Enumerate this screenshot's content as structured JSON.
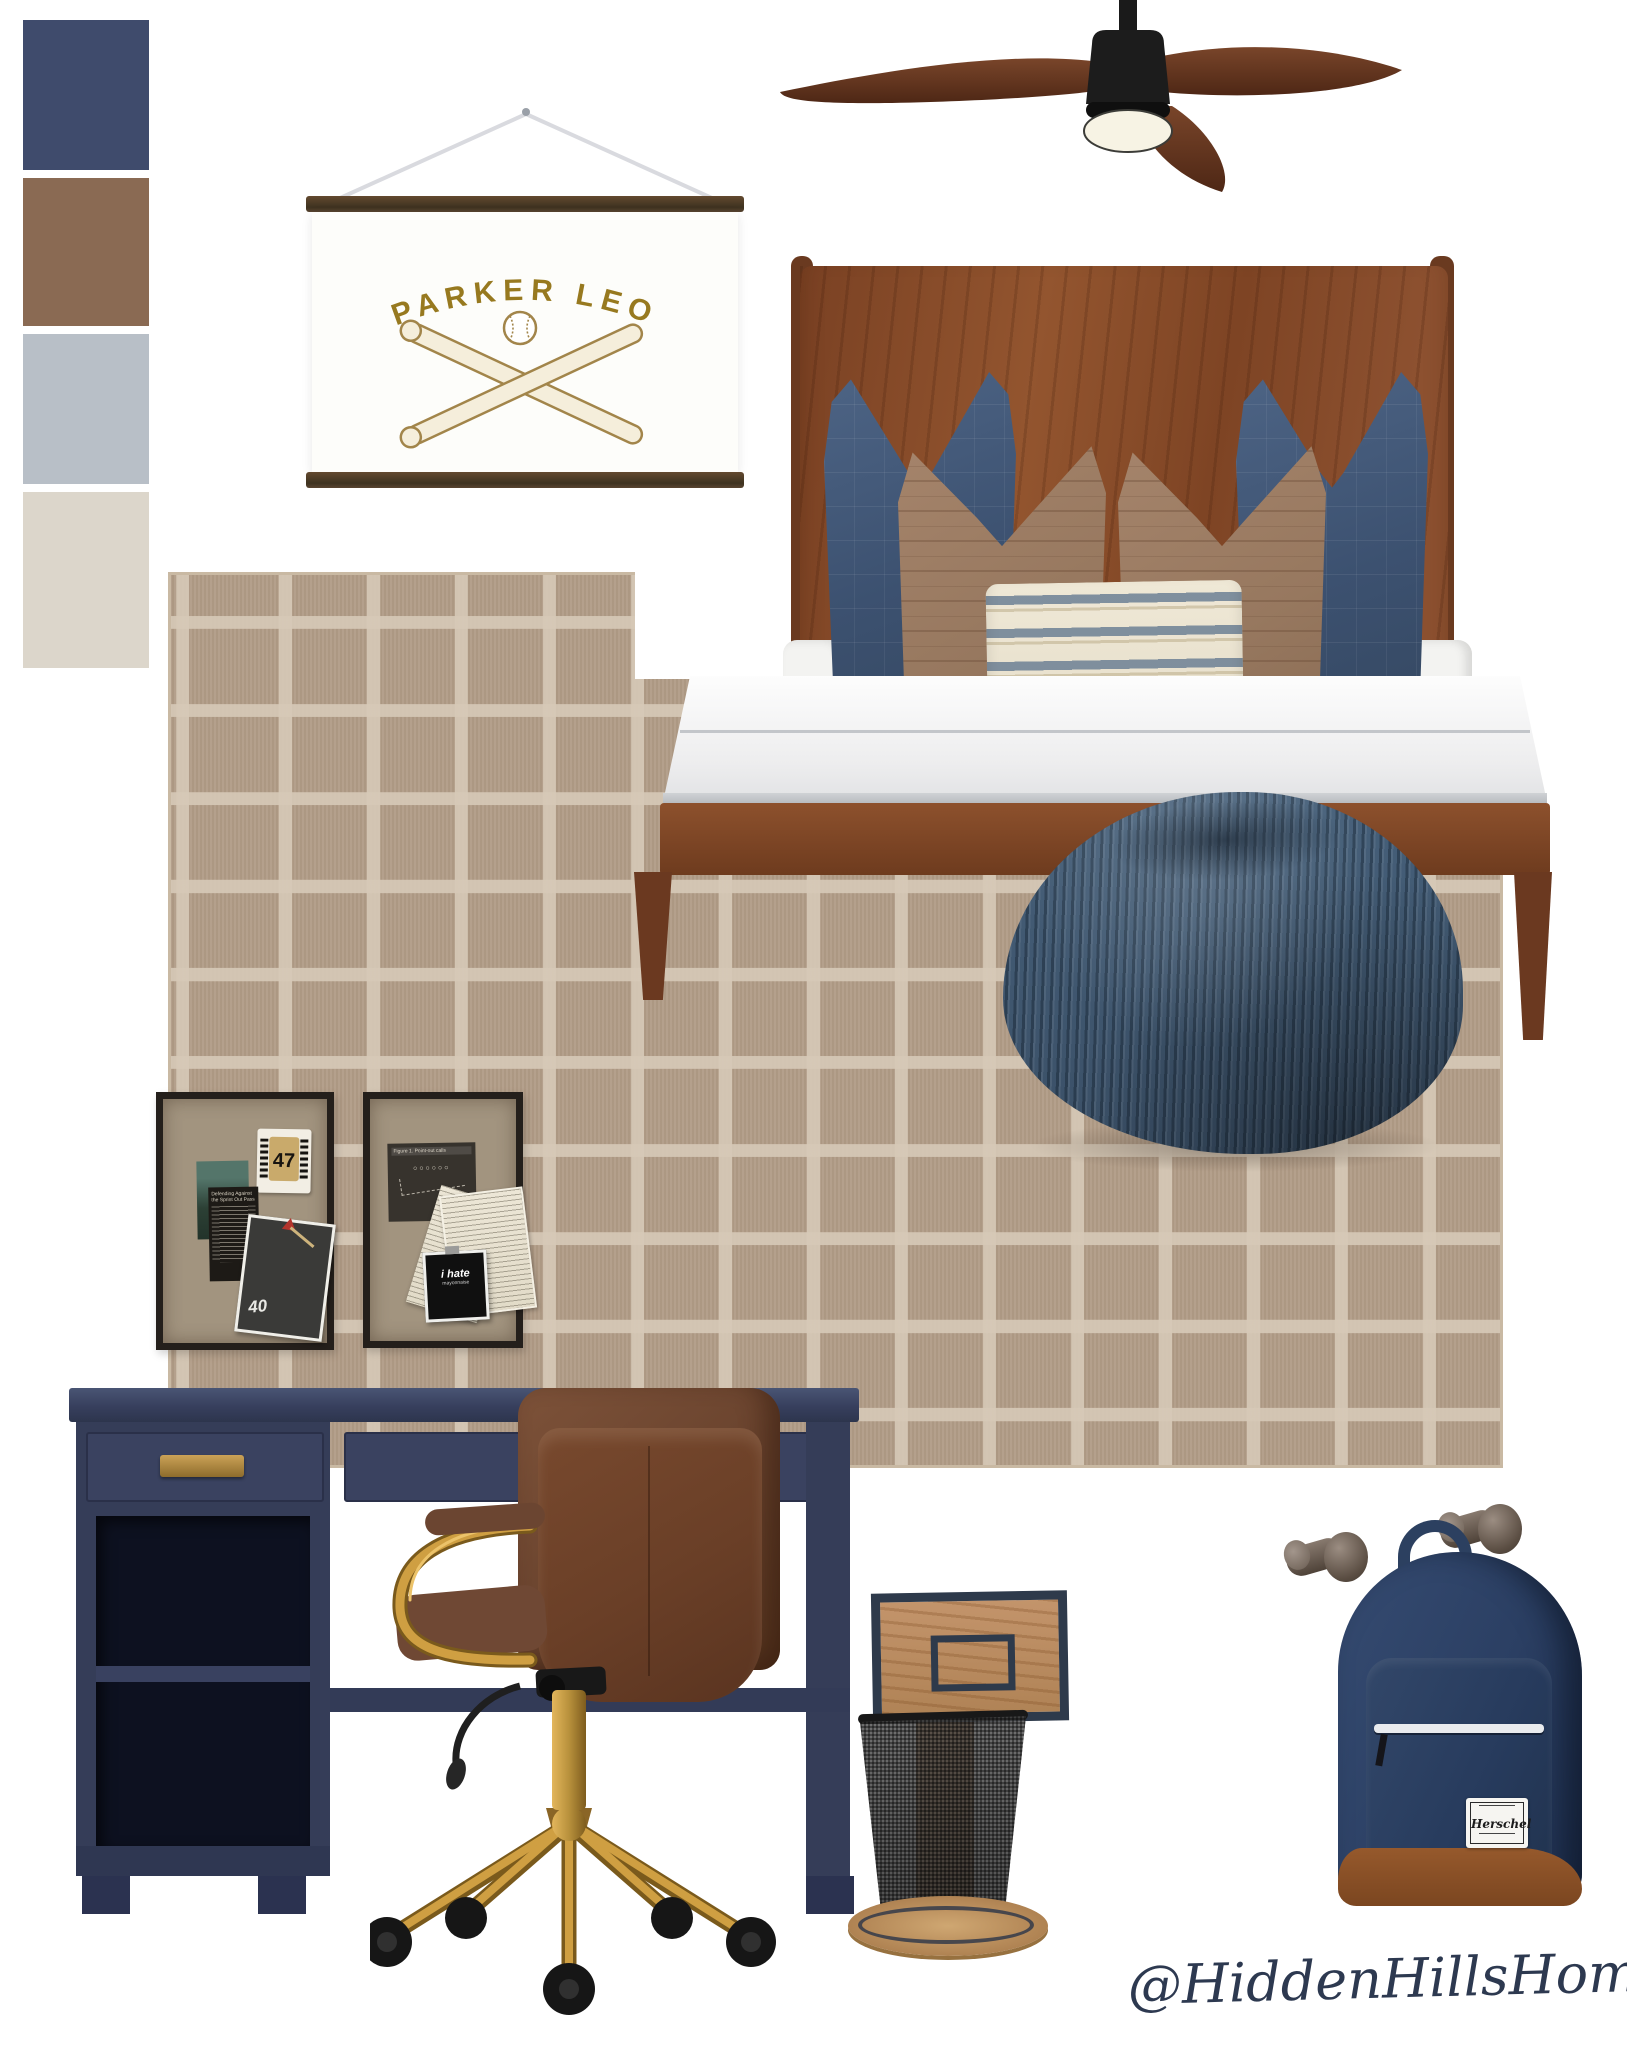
{
  "palette": {
    "colors": [
      "#3f4b6c",
      "#8a6a53",
      "#b8bfc7",
      "#dcd6cb"
    ]
  },
  "banner": {
    "name": "PARKER LEO"
  },
  "pinboards": {
    "left": {
      "jersey_number": "47",
      "article_title": "Defending Against the Sprint Out Pass",
      "yard_line": "40"
    },
    "right": {
      "figure_caption": "Figure 1. Point-out calls",
      "polaroid_line1": "i hate",
      "polaroid_line2": "mayonnaise"
    }
  },
  "backpack": {
    "brand": "Herschel"
  },
  "watermark": {
    "handle": "@HiddenHillsHome"
  }
}
